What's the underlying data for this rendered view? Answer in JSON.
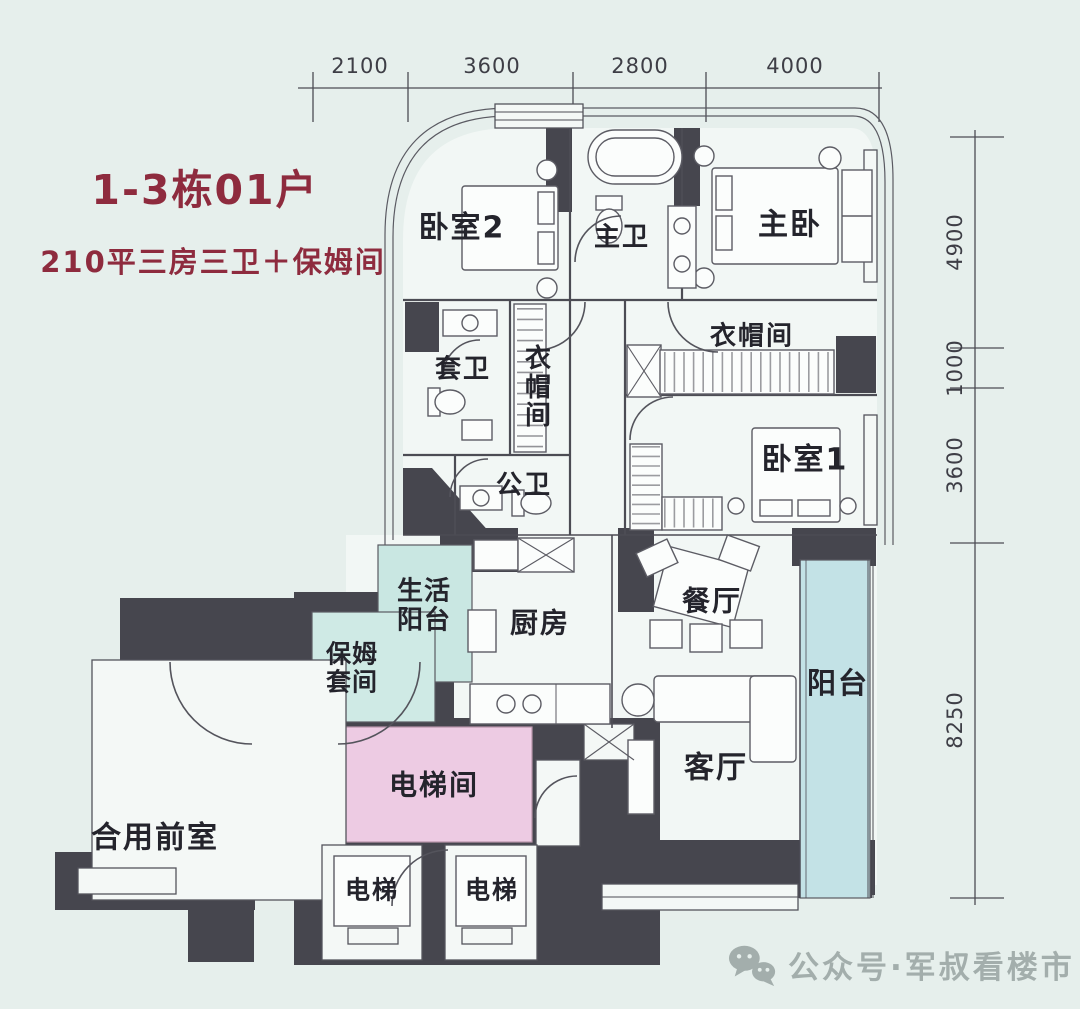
{
  "header": {
    "title": "1-3栋01户",
    "subtitle": "210平三房三卫＋保姆间"
  },
  "dimensions": {
    "top": [
      "2100",
      "3600",
      "2800",
      "4000"
    ],
    "right": [
      "4900",
      "1000",
      "3600",
      "8250"
    ]
  },
  "rooms": {
    "bedroom2": "卧室2",
    "master_bath": "主卫",
    "master_bedroom": "主卧",
    "ensuite_bath": "套卫",
    "closet_center": "衣帽间",
    "closet_right": "衣帽间",
    "public_bath": "公卫",
    "bedroom1": "卧室1",
    "service_balcony": "生活阳台",
    "kitchen": "厨房",
    "dining": "餐厅",
    "nanny_suite": "保姆套间",
    "balcony": "阳台",
    "living": "客厅",
    "elevator_hall": "电梯间",
    "shared_front_room": "合用前室",
    "elevator_left": "电梯",
    "elevator_right": "电梯"
  },
  "watermark": {
    "icon": "wechat-icon",
    "text": "公众号·军叔看楼市"
  },
  "colors": {
    "background": "#e6efec",
    "wall_dark": "#46464e",
    "teal_room": "#c9e7e2",
    "balcony_teal": "#c3e2e6",
    "elevator_pink": "#edcbe3",
    "title_red": "#8e2b3e",
    "watermark_gray": "#a3aeac"
  }
}
